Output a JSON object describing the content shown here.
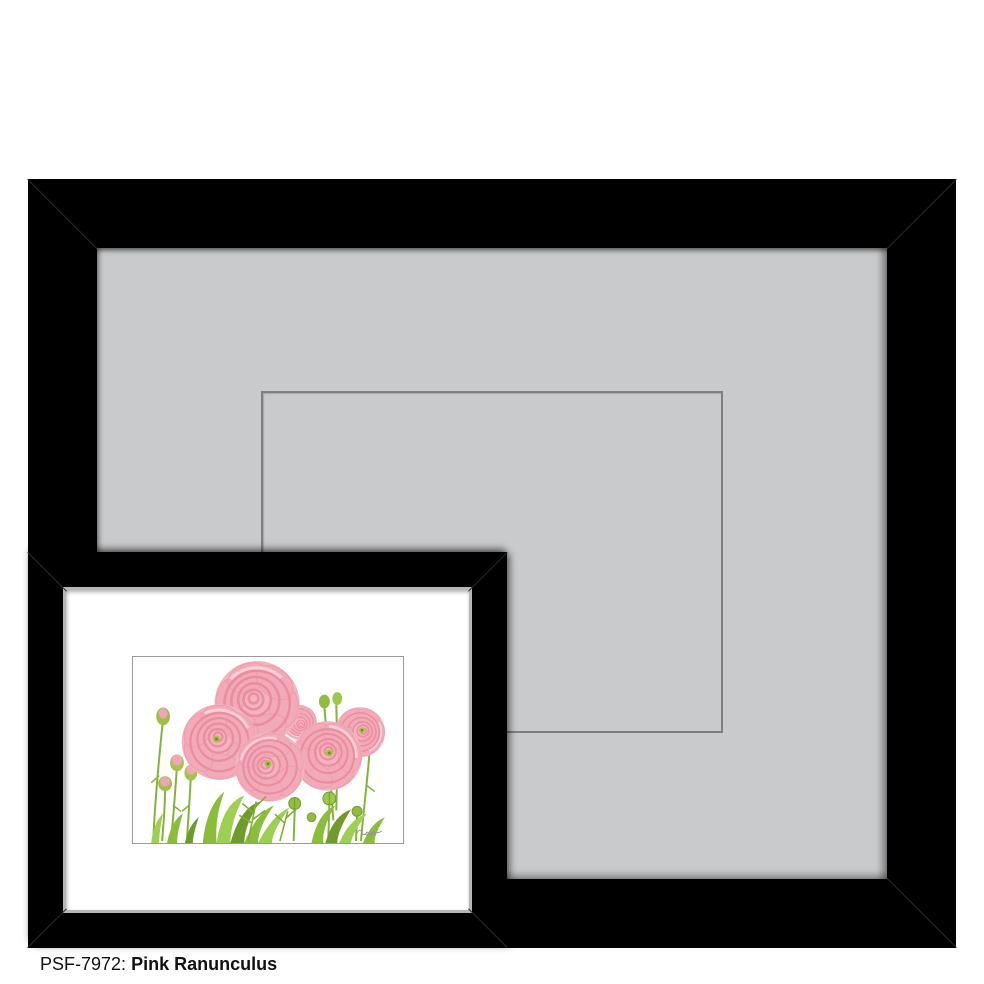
{
  "page": {
    "background_color": "#ffffff"
  },
  "caption": {
    "product_code": "PSF-7972:",
    "artwork_title": "Pink Ranunculus"
  },
  "large_frame": {
    "frame_color": "#000000",
    "mat_color": "#c9cacc",
    "mat_opening_outline_color": "#7d7f82"
  },
  "small_frame": {
    "frame_color": "#000000",
    "liner_color": "#b3b7b9",
    "mat_color": "#ffffff",
    "artwork_subject": "Watercolor illustration of pink ranunculus flowers with green stems, buds and foliage",
    "flower_pink_color": "#f2a7b5",
    "leaf_green_color": "#8abd3c"
  }
}
